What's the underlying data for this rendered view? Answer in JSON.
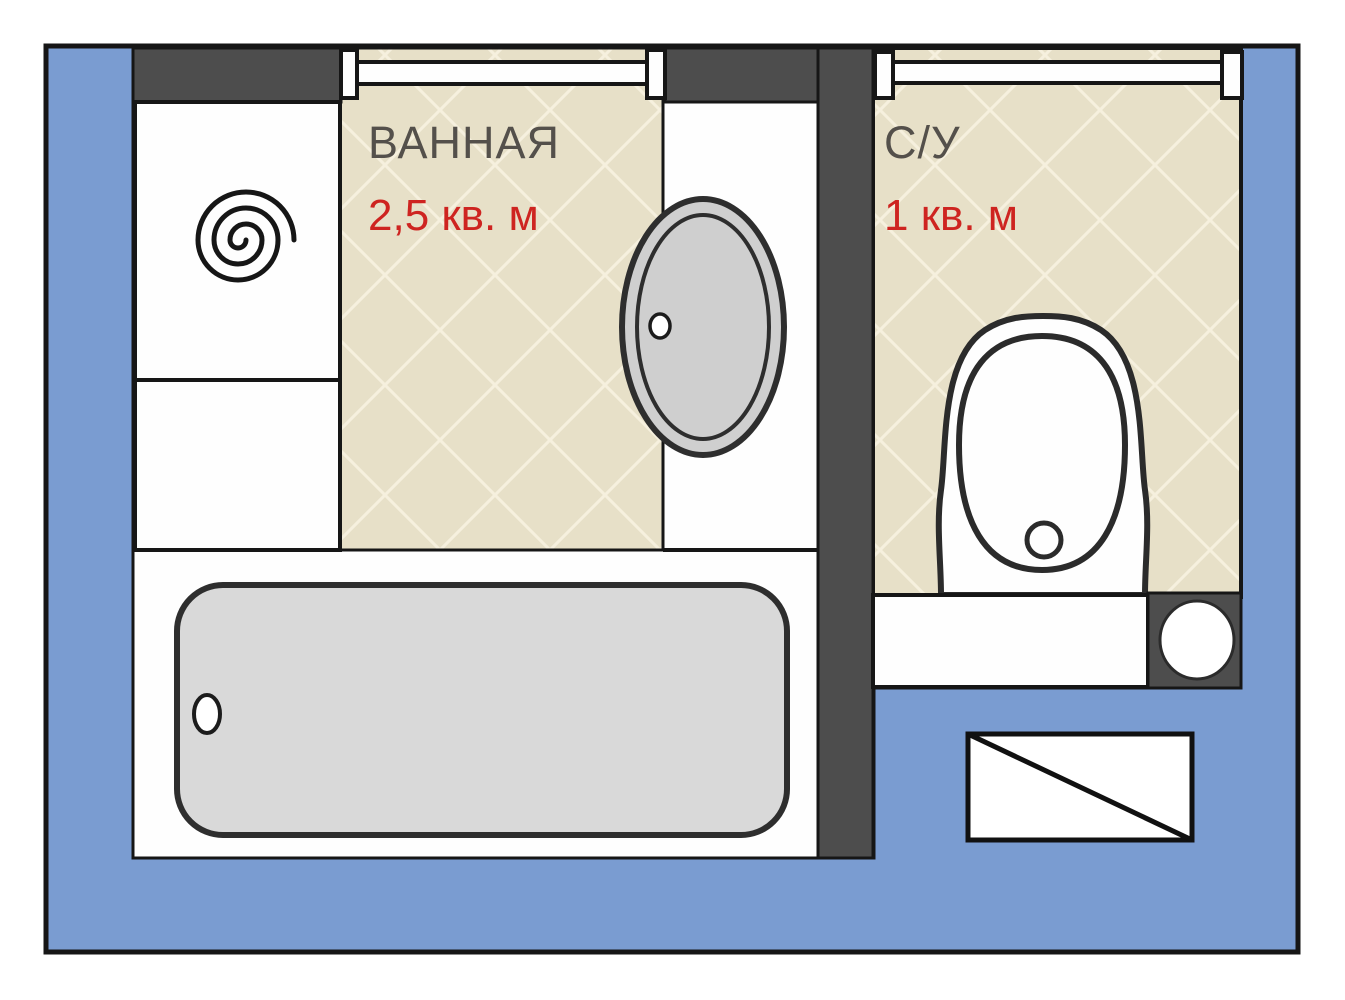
{
  "diagram": {
    "type": "bathroom-floor-plan",
    "rooms": [
      {
        "id": "bathroom",
        "name": "ВАННАЯ",
        "area": "2,5 кв. м"
      },
      {
        "id": "wc",
        "name": "С/У",
        "area": "1 кв. м"
      }
    ],
    "fixtures": {
      "washing_machine": "washing-machine (spiral symbol)",
      "storage_box": "cabinet / storage",
      "bathtub": "bathtub with drain",
      "sink": "oval sink with drain",
      "toilet": "toilet with bowl and flush button",
      "pipe_riser": "pipe riser (dark block with circle)",
      "door_bathroom": "bathroom doorway with jambs",
      "door_wc": "wc doorway with jambs",
      "legend_box": "hatched rectangle symbol"
    },
    "colors": {
      "background": "#FFFFFF",
      "plan_blue": "#7A9CD1",
      "wall_dark": "#4D4D4D",
      "tile_beige": "#E7E0C8",
      "tile_grout": "#F6F0DE",
      "fixture_gray": "#D9D9D9",
      "sink_gray": "#CFCFCF",
      "outline_black": "#1C1C1C",
      "label_gray": "#54504B",
      "area_red": "#CE2420"
    }
  }
}
